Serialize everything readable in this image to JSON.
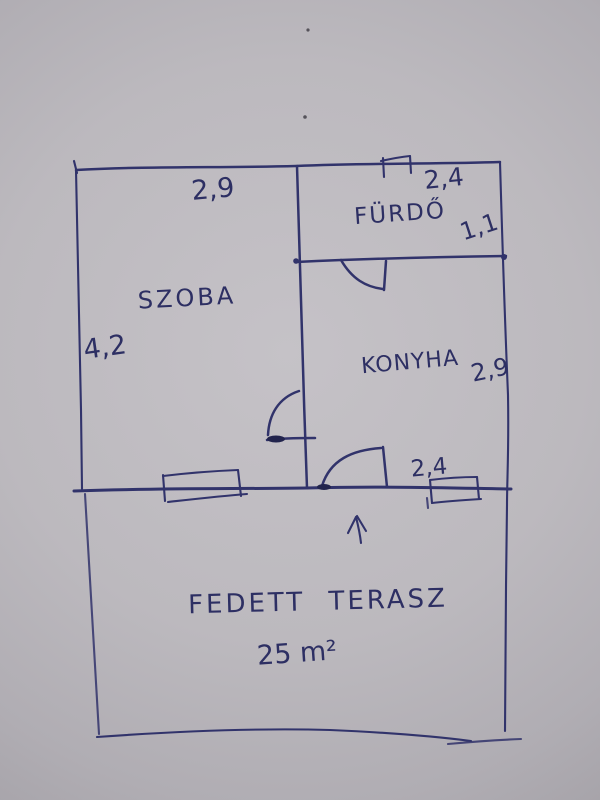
{
  "palette": {
    "paper": "#bcb9be",
    "paper_edge": "#8f8c92",
    "ink": "#31336b"
  },
  "floor_plan": {
    "rooms": {
      "szoba": {
        "label": "SZOBA",
        "width_m": "2,9",
        "height_m": "4,2"
      },
      "furdo": {
        "label": "FÜRDŐ",
        "width_m": "2,4",
        "height_m": "1,1"
      },
      "konyha": {
        "label": "KONYHA",
        "height_m": "2,9",
        "entrance_width_m": "2,4"
      },
      "terasz": {
        "label": "FEDETT TERASZ",
        "area": "25 m²"
      }
    }
  }
}
